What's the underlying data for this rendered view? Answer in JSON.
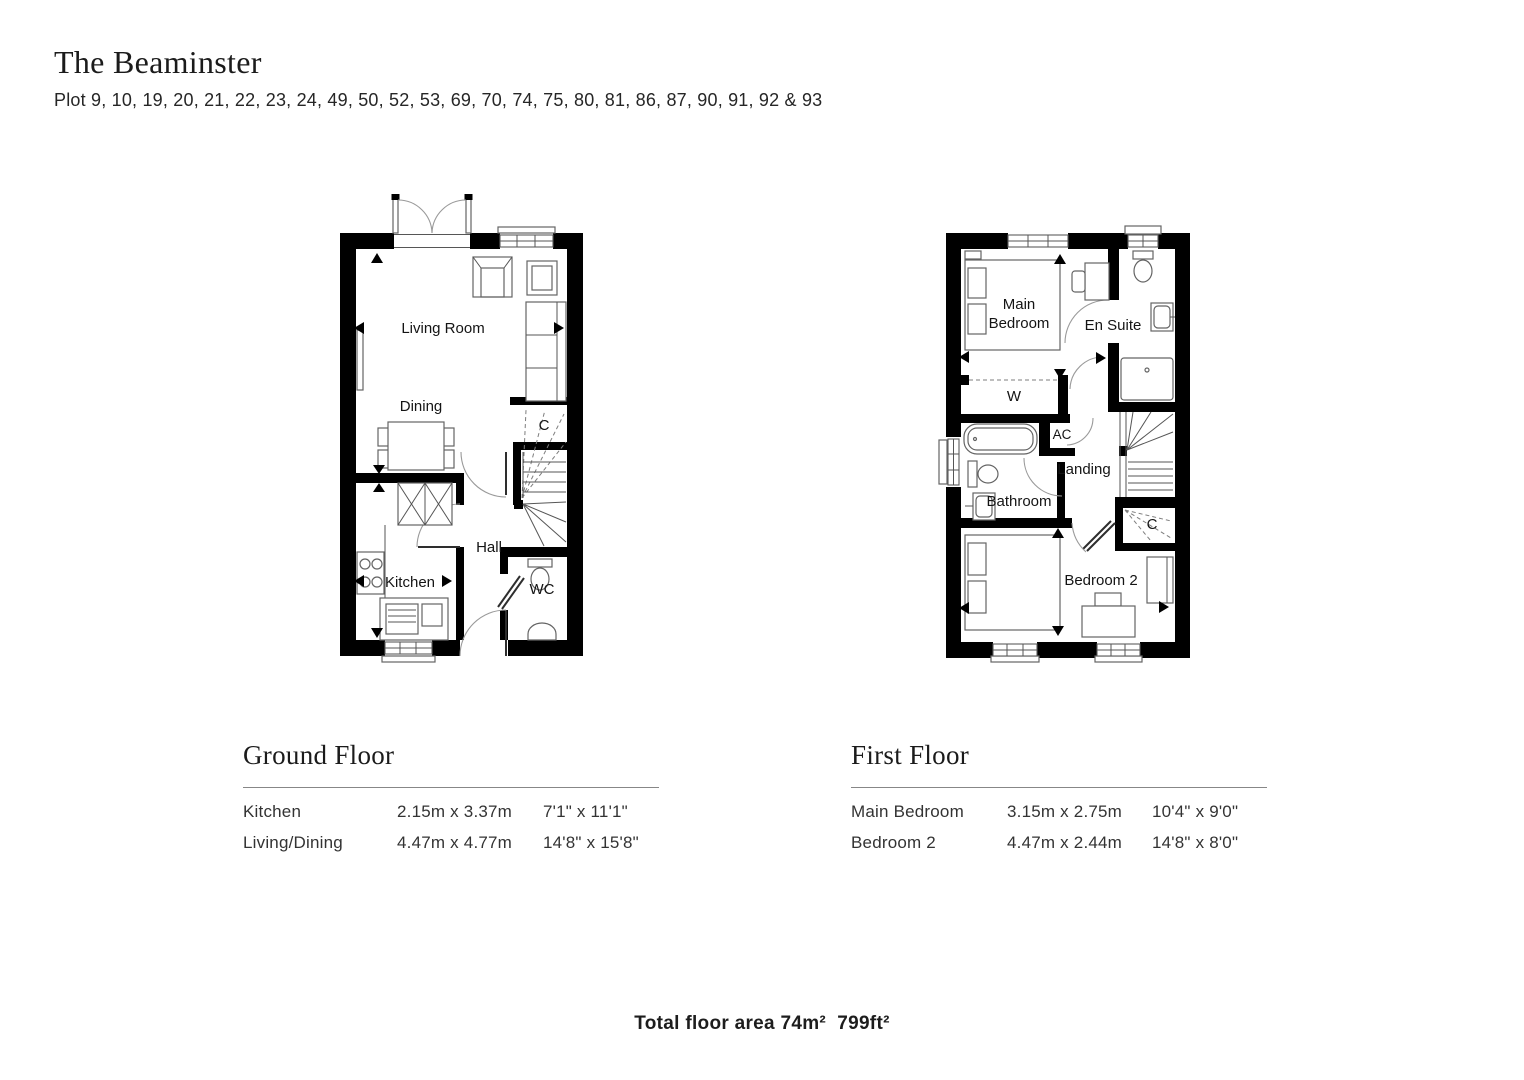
{
  "header": {
    "title": "The Beaminster",
    "subtitle": "Plot 9, 10, 19, 20, 21, 22, 23, 24, 49, 50, 52, 53, 69, 70, 74, 75, 80, 81, 86, 87, 90, 91, 92 & 93"
  },
  "plans": {
    "ground": {
      "rooms": {
        "living": "Living Room",
        "dining": "Dining",
        "kitchen": "Kitchen",
        "hall": "Hall",
        "cupboard": "C",
        "wc": "WC"
      }
    },
    "first": {
      "rooms": {
        "main_line1": "Main",
        "main_line2": "Bedroom",
        "ensuite": "En Suite",
        "wardrobe": "W",
        "ac": "AC",
        "landing": "Landing",
        "bathroom": "Bathroom",
        "cupboard": "C",
        "bedroom2": "Bedroom 2"
      }
    }
  },
  "tables": {
    "ground": {
      "heading": "Ground Floor",
      "rows": [
        {
          "room": "Kitchen",
          "metric": "2.15m x 3.37m",
          "imperial": "7'1\" x 11'1\""
        },
        {
          "room": "Living/Dining",
          "metric": "4.47m x 4.77m",
          "imperial": "14'8\" x 15'8\""
        }
      ]
    },
    "first": {
      "heading": "First Floor",
      "rows": [
        {
          "room": "Main Bedroom",
          "metric": "3.15m x 2.75m",
          "imperial": "10'4\" x 9'0\""
        },
        {
          "room": "Bedroom 2",
          "metric": "4.47m x 2.44m",
          "imperial": "14'8\" x 8'0\""
        }
      ]
    }
  },
  "footer": {
    "total_area": "Total floor area 74m²  799ft²"
  },
  "colors": {
    "wall": "#000000",
    "furniture_line": "#646464",
    "text": "#1d1d1d"
  }
}
